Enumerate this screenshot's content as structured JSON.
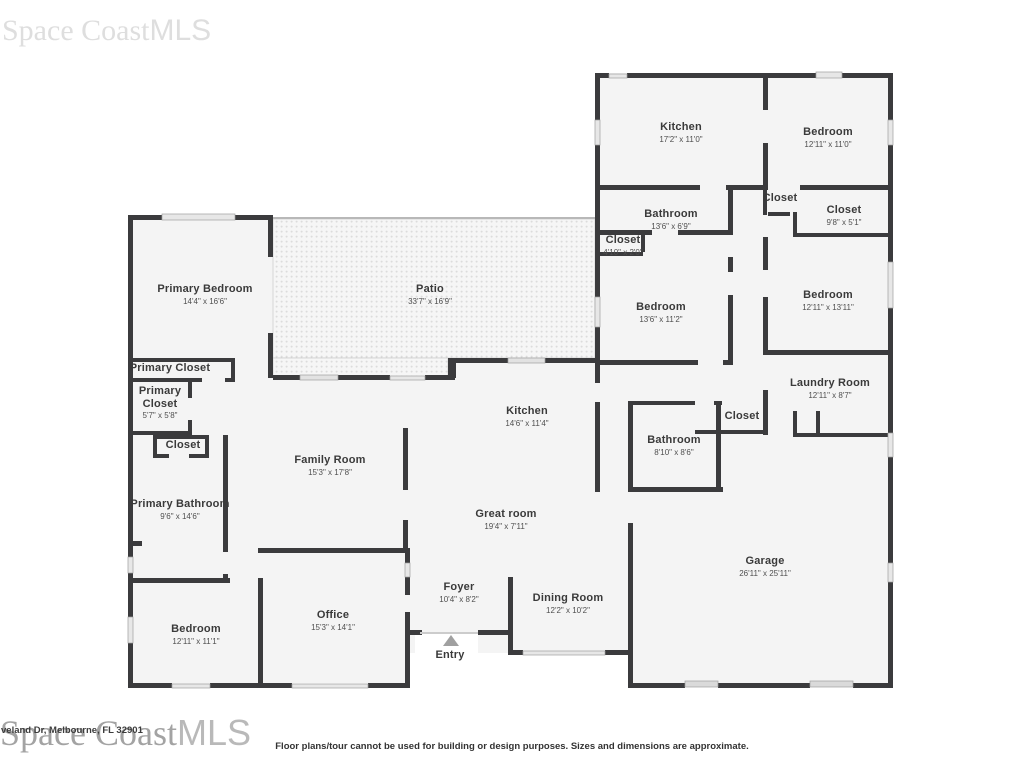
{
  "watermarks": {
    "top_brand": "Space Coast",
    "top_suffix": "MLS",
    "bottom_brand": "Space Coast",
    "bottom_suffix": "MLS",
    "address_fragment": "veland Dr, Melbourne, FL 32901"
  },
  "disclaimer": "Floor plans/tour cannot be used for building or design purposes. Sizes and dimensions are approximate.",
  "colors": {
    "wall": "#3b3b3d",
    "room_fill": "#f4f4f4",
    "patio_dot": "#dcdcdc",
    "window_fill": "#e7e7e7",
    "entry_arrow": "#a0a0a0"
  },
  "rooms": [
    {
      "name": "Kitchen",
      "dims": "17'2\" x 11'0\""
    },
    {
      "name": "Bedroom",
      "dims": "12'11\" x 11'0\""
    },
    {
      "name": "Bathroom",
      "dims": "13'6\" x 6'9\""
    },
    {
      "name": "Closet",
      "dims": ""
    },
    {
      "name": "Closet",
      "dims": "9'8\" x 5'1\""
    },
    {
      "name": "Closet",
      "dims": "4'10\" x 2'0\""
    },
    {
      "name": "Bedroom",
      "dims": "13'6\" x 11'2\""
    },
    {
      "name": "Bedroom",
      "dims": "12'11\" x 13'11\""
    },
    {
      "name": "Primary Bedroom",
      "dims": "14'4\" x 16'6\""
    },
    {
      "name": "Patio",
      "dims": "33'7\" x 16'9\""
    },
    {
      "name": "Primary Closet",
      "dims": ""
    },
    {
      "name": "Primary Closet",
      "dims": "5'7\" x 5'8\""
    },
    {
      "name": "Closet",
      "dims": ""
    },
    {
      "name": "Laundry Room",
      "dims": "12'11\" x 8'7\""
    },
    {
      "name": "Kitchen",
      "dims": "14'6\" x 11'4\""
    },
    {
      "name": "Closet",
      "dims": ""
    },
    {
      "name": "Bathroom",
      "dims": "8'10\" x 8'6\""
    },
    {
      "name": "Family Room",
      "dims": "15'3\" x 17'8\""
    },
    {
      "name": "Primary Bathroom",
      "dims": "9'6\" x 14'6\""
    },
    {
      "name": "Great room",
      "dims": "19'4\" x 7'11\""
    },
    {
      "name": "Garage",
      "dims": "26'11\" x 25'11\""
    },
    {
      "name": "Foyer",
      "dims": "10'4\" x 8'2\""
    },
    {
      "name": "Office",
      "dims": "15'3\" x 14'1\""
    },
    {
      "name": "Dining Room",
      "dims": "12'2\" x 10'2\""
    },
    {
      "name": "Bedroom",
      "dims": "12'11\" x 11'1\""
    },
    {
      "name": "Entry",
      "dims": ""
    }
  ]
}
